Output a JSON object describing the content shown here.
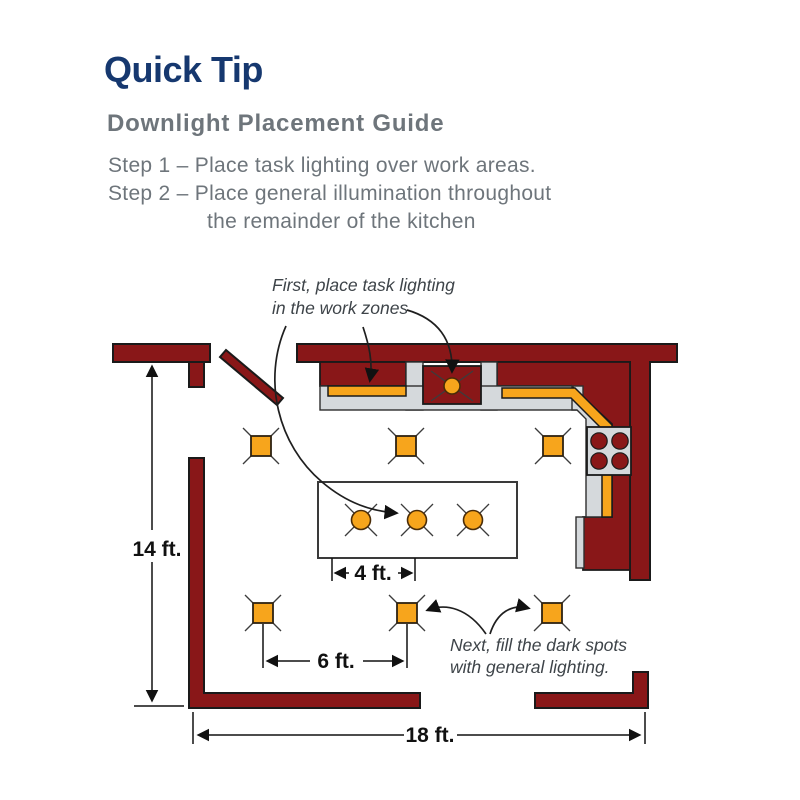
{
  "header": {
    "title": "Quick Tip",
    "subtitle": "Downlight Placement Guide",
    "step1": "Step 1 – Place task lighting over work areas.",
    "step2_line1": "Step 2 – Place general illumination throughout",
    "step2_line2": "the remainder of the kitchen"
  },
  "diagram": {
    "annotation_task_line1": "First, place task lighting",
    "annotation_task_line2": "in the work zones",
    "annotation_general_line1": "Next, fill the dark spots",
    "annotation_general_line2": "with general lighting.",
    "dim_height": "14 ft.",
    "dim_island_spacing": "4 ft.",
    "dim_general_spacing": "6 ft.",
    "dim_width": "18 ft."
  },
  "fixtures": {
    "general_downlight_icon": "square-downlight-icon",
    "task_downlight_icon": "round-downlight-icon"
  },
  "colors": {
    "brand_navy": "#16386F",
    "text_gray": "#6E757B",
    "wall_red": "#891718",
    "light_orange": "#F7A51C",
    "counter_gray": "#D5D9DC"
  }
}
